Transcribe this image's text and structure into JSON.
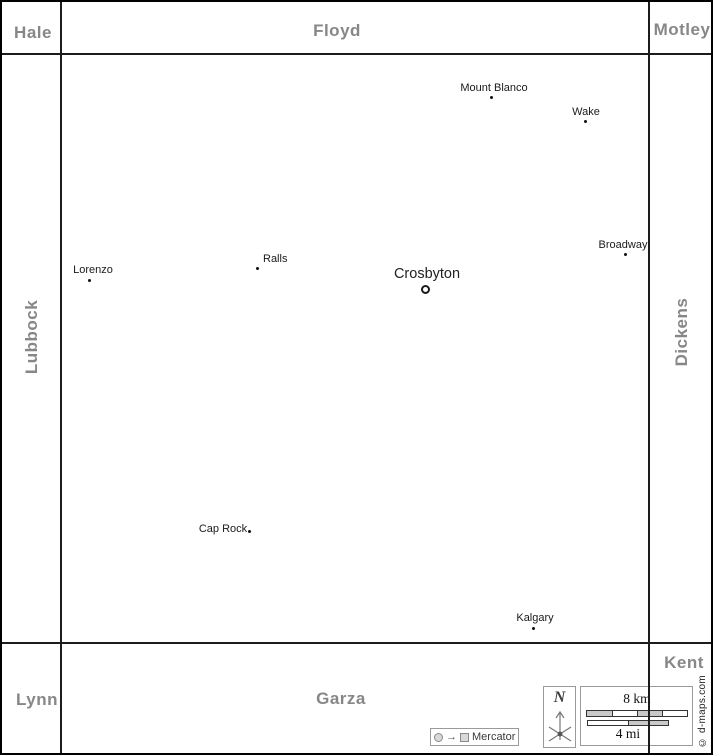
{
  "map": {
    "region": "Crosby County and neighbors",
    "counties": {
      "hale": "Hale",
      "floyd": "Floyd",
      "motley": "Motley",
      "lubbock": "Lubbock",
      "dickens": "Dickens",
      "lynn": "Lynn",
      "garza": "Garza",
      "kent": "Kent"
    },
    "places": [
      {
        "name": "Mount Blanco",
        "type": "town"
      },
      {
        "name": "Wake",
        "type": "town"
      },
      {
        "name": "Broadway",
        "type": "town"
      },
      {
        "name": "Lorenzo",
        "type": "town"
      },
      {
        "name": "Ralls",
        "type": "town"
      },
      {
        "name": "Crosbyton",
        "type": "county-seat"
      },
      {
        "name": "Cap Rock",
        "type": "town"
      },
      {
        "name": "Kalgary",
        "type": "town"
      }
    ],
    "compass": {
      "north_label": "N"
    },
    "scale": {
      "km": "8 km",
      "mi": "4 mi"
    },
    "projection": {
      "label": "Mercator",
      "arrow": "→"
    },
    "copyright": "© d-maps.com",
    "colors": {
      "county_label": "#878787",
      "place_label": "#1a1a1a",
      "border_line": "#1c1c1c",
      "scale_fill": "#c9c9c9",
      "frame": "#000000"
    }
  }
}
